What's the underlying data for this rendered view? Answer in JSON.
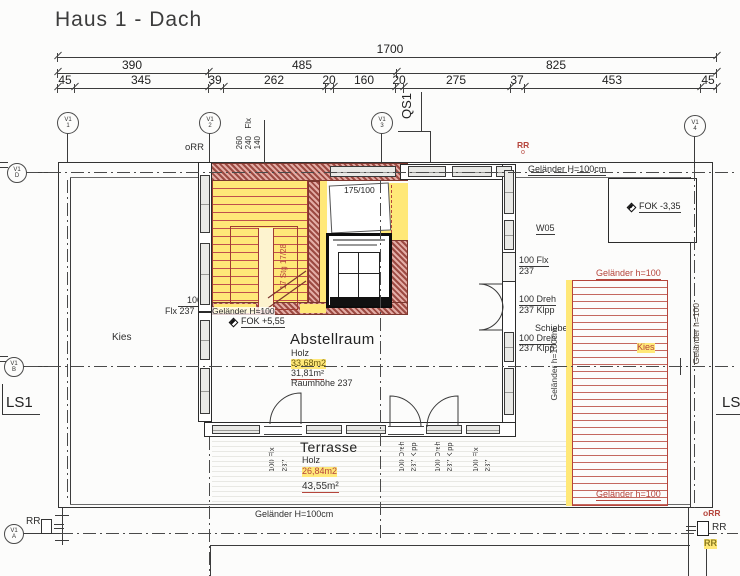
{
  "title": "Haus 1 - Dach",
  "dims": {
    "total": "1700",
    "row2": [
      "390",
      "485",
      "825"
    ],
    "row3": [
      "45",
      "345",
      "39",
      "262",
      "20",
      "160",
      "20",
      "275",
      "37",
      "453",
      "45"
    ]
  },
  "axes": {
    "prefix": "V1",
    "top": [
      "1",
      "2",
      "3",
      "4"
    ],
    "left": [
      "D",
      "B",
      "A"
    ]
  },
  "section": {
    "qs1": "QS1",
    "ls1": "LS1"
  },
  "levels": {
    "fok_stair": "FOK +5,55",
    "fok_box": "FOK -3,35"
  },
  "railing": {
    "top_right": "Geländer H=100cm",
    "bottom": "Geländer H=100cm",
    "stair": "Geländer H=100",
    "kies_top": "Geländer h=100",
    "kies_bottom": "Geländer h=100",
    "kies_right_vert": "Geländer h=100",
    "kies_left_vert": "Geländer h=100cm"
  },
  "rooms": {
    "abstellraum": {
      "name": "Abstellraum",
      "material": "Holz",
      "area_yellow": "33,68m2",
      "area_red": "31,81m²",
      "height": "Raumhöhe 237"
    },
    "terrasse": {
      "name": "Terrasse",
      "material": "Holz",
      "area_yellow": "26,84m2",
      "area_red": "43,55m²"
    }
  },
  "kies": {
    "left": "Kies",
    "right": "Kies"
  },
  "stair": {
    "label": "17 Stg 17/28"
  },
  "door": {
    "opening": "175/100"
  },
  "win": {
    "w05_left": "W05",
    "w05_right": "W05",
    "left_flx": [
      "100",
      "Flx 237"
    ],
    "right_flx": [
      "100 Flx",
      "237"
    ],
    "right_dreh1": [
      "100 Dreh",
      "237 Klpp"
    ],
    "schiebe": "Schiebe",
    "right_dreh2": [
      "100 Dreh",
      "237 Klpp"
    ],
    "top_vert_dims": [
      "260",
      "240",
      "140"
    ],
    "top_vert_flx": "Flx",
    "bottom_left": [
      "100 Flx",
      "237"
    ],
    "bottom_dreh1": [
      "100 Dreh",
      "237 Klpp"
    ],
    "bottom_dreh2": [
      "100 Dreh",
      "237 Klpp"
    ],
    "bottom_right": [
      "100 Flx",
      "237"
    ]
  },
  "rr": {
    "top_left": "oRR",
    "top_center": "RR",
    "top_center_o": "o",
    "bottom_left": "RR",
    "br_red": "oRR",
    "br_black": "RR",
    "br_yellow": "RR"
  },
  "colors": {
    "red_line": "#b5453c",
    "yellow": "#ffe878",
    "hatch": "#9c4a42"
  }
}
